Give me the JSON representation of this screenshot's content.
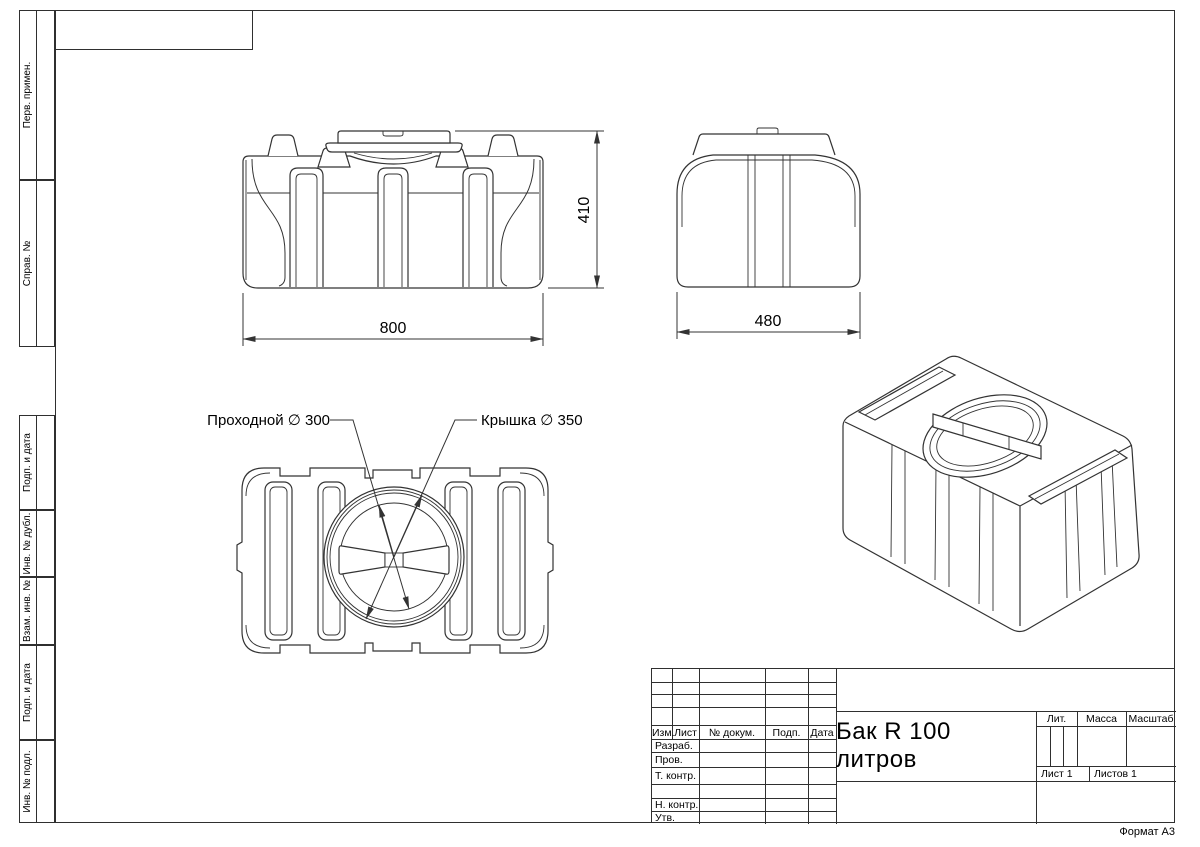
{
  "sheet": {
    "format_note": "Формат А3"
  },
  "margin_labels": {
    "perv_primen": "Перв. примен.",
    "sprav_no": "Справ. №",
    "podp_i_data_1": "Подп. и дата",
    "inv_no_dubl": "Инв. № дубл.",
    "vzam_inv_no": "Взам. инв. №",
    "podp_i_data_2": "Подп. и дата",
    "inv_no_podl": "Инв. № подл."
  },
  "title_block": {
    "doc_title": "Бак R 100 литров",
    "col_izm": "Изм.",
    "col_list": "Лист",
    "col_ndocum": "№ докум.",
    "col_podp": "Подп.",
    "col_data": "Дата",
    "row_razrab": "Разраб.",
    "row_prov": "Пров.",
    "row_tkontr": "Т. контр.",
    "row_nkontr": "Н. контр.",
    "row_utv": "Утв.",
    "lit": "Лит.",
    "massa": "Масса",
    "masshtab": "Масштаб",
    "list": "Лист 1",
    "listov": "Листов 1"
  },
  "views": {
    "front": {
      "dim_width": "800",
      "dim_height": "410"
    },
    "side": {
      "dim_width": "480"
    },
    "top": {
      "callout_passage": "Проходной ∅ 300",
      "callout_lid": "Крышка ∅ 350"
    }
  },
  "colors": {
    "line": "#333333",
    "frame": "#2f2f2f",
    "text": "#000000"
  }
}
